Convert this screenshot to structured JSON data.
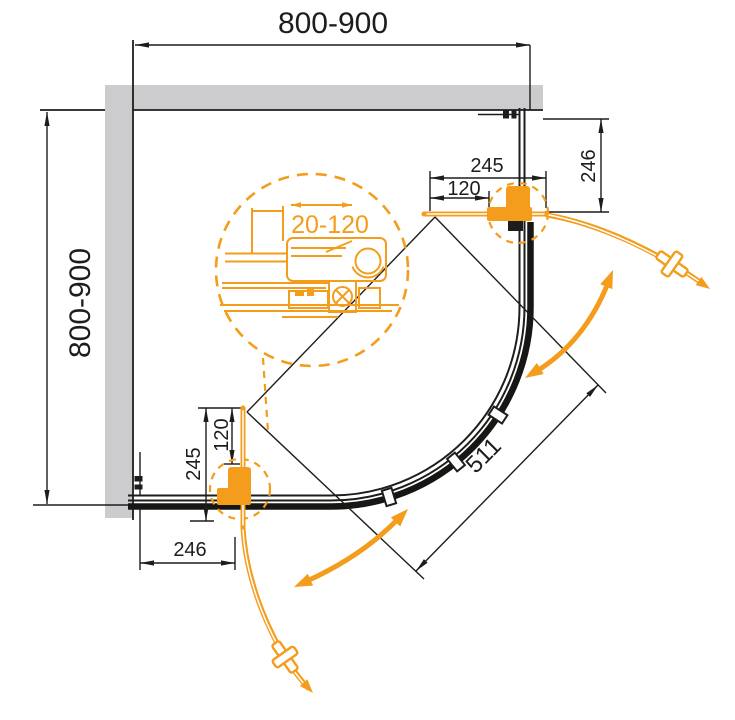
{
  "diagram": {
    "type": "technical-drawing",
    "subject": "quadrant corner shower enclosure - plan view with sliding curved doors",
    "colors": {
      "accent_orange": "#F49C1B",
      "line_black": "#1D1D1B",
      "wall_gray": "#CCCCCE"
    },
    "icons": {
      "door_knob": "cross-knob-icon",
      "swing_direction": "curved-double-arrow-icon",
      "adjustment": "double-headed-arrow-icon"
    },
    "dims": {
      "top_width": "800-900",
      "left_depth": "800-900",
      "top_door_width": "245",
      "top_handle_offset": "120",
      "top_fixed_panel": "246",
      "bottom_door_width": "245",
      "bottom_handle_offset": "120",
      "bottom_fixed_panel": "246",
      "entry_width": "511",
      "profile_adjustment": "20-120"
    }
  }
}
